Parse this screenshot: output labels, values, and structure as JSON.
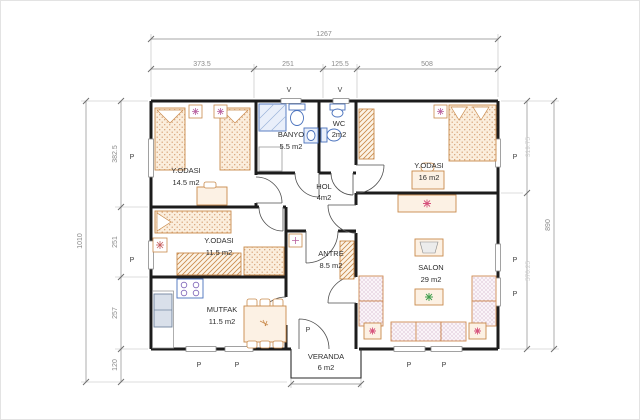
{
  "plan": {
    "rooms": {
      "yodasi1": {
        "label": "Y.ODASI",
        "area": "14.5 m2"
      },
      "banyo": {
        "label": "BANYO",
        "area": "5.5 m2"
      },
      "wc": {
        "label": "WC",
        "area": "2m2"
      },
      "yodasi2": {
        "label": "Y.ODASI",
        "area": "16 m2"
      },
      "hol": {
        "label": "HOL",
        "area": "4m2"
      },
      "yodasi3": {
        "label": "Y.ODASI",
        "area": "11.5 m2"
      },
      "antre": {
        "label": "ANTRE",
        "area": "8.5 m2"
      },
      "mutfak": {
        "label": "MUTFAK",
        "area": "11.5 m2"
      },
      "salon": {
        "label": "SALON",
        "area": "29 m2"
      },
      "veranda": {
        "label": "VERANDA",
        "area": "6 m2"
      }
    },
    "dimensions": {
      "top_total": "1267",
      "top_segments": [
        "373.5",
        "251",
        "125.5",
        "508"
      ],
      "left_total": "1010",
      "left_segments": [
        "382.5",
        "251",
        "257",
        "120"
      ],
      "right_total": "890",
      "right_segments": [
        "319.75",
        "570.25"
      ]
    },
    "markers": {
      "window": "P",
      "vent": "V"
    },
    "colors": {
      "wall": "#1c1c1c",
      "dimension": "#8a8a8a",
      "furniture": "#c98a4b",
      "fixture": "#4a72bd",
      "sofa": "#c79ebd",
      "plant_red": "#d6527c",
      "plant_green": "#3f9e4d"
    }
  }
}
